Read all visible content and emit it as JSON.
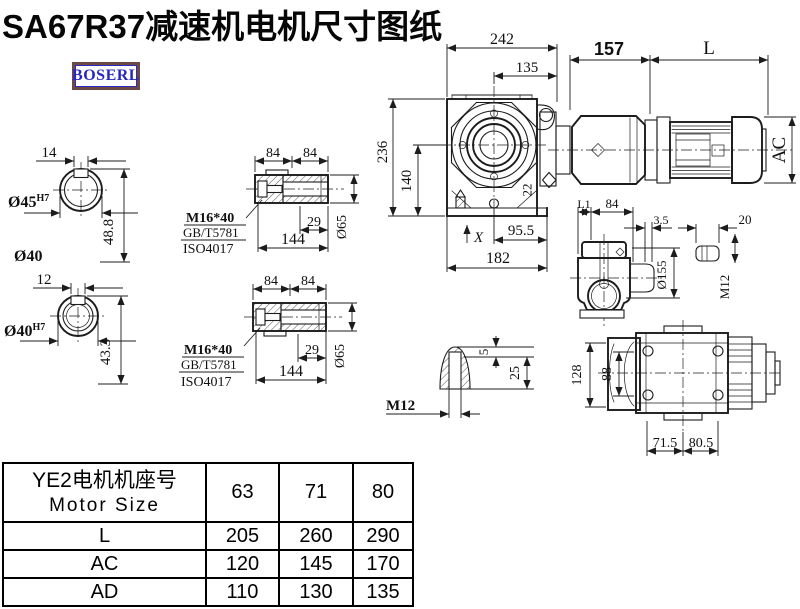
{
  "title": "SA67R37减速机电机尺寸图纸",
  "brand": {
    "text": "BOSERL"
  },
  "colors": {
    "line": "#1c1c1c",
    "brand_text": "#2626c0",
    "brand_border": "#6e4a45",
    "background": "#ffffff"
  },
  "drawing": {
    "shaft_top": {
      "keyway_width": "14",
      "bore": "Ø45",
      "bore_tol": "H7",
      "depth": "48.8",
      "outer_dia": "Ø40"
    },
    "shaft_bottom": {
      "keyway_width": "12",
      "bore": "Ø40",
      "bore_tol": "H7",
      "depth": "43.3"
    },
    "bushing_top": {
      "len1": "84",
      "len2": "84",
      "thread": "M16*40",
      "std1": "GB/T5781",
      "std2": "ISO4017",
      "key_len": "29",
      "total_len": "144",
      "dia": "Ø65"
    },
    "bushing_bottom": {
      "len1": "84",
      "len2": "84",
      "thread": "M16*40",
      "std1": "GB/T5781",
      "std2": "ISO4017",
      "key_len": "29",
      "total_len": "144",
      "dia": "Ø65"
    },
    "front_view": {
      "overall_w": "242",
      "center_to_face": "135",
      "adapter_len": "157",
      "motor_len": "L",
      "overall_h": "236",
      "center_h": "140",
      "foot": "22",
      "foot_to_center": "95.5",
      "base_len": "182",
      "datum": "X",
      "motor_dia": "AC"
    },
    "side_view": {
      "l1": "L1",
      "w84": "84",
      "gap": "3.5",
      "flange_dia": "Ø155",
      "stud_len": "20",
      "stud_thread": "M12"
    },
    "bottom_view": {
      "h128": "128",
      "h88": "88",
      "w1": "71.5",
      "w2": "80.5"
    },
    "plug_view": {
      "thread": "M12",
      "d5": "5",
      "d25": "25"
    }
  },
  "table": {
    "header": {
      "line1": "YE2电机机座号",
      "line2": "Motor Size"
    },
    "sizes": [
      "63",
      "71",
      "80"
    ],
    "rows": [
      {
        "label": "L",
        "values": [
          "205",
          "260",
          "290"
        ]
      },
      {
        "label": "AC",
        "values": [
          "120",
          "145",
          "170"
        ]
      },
      {
        "label": "AD",
        "values": [
          "110",
          "130",
          "135"
        ]
      }
    ]
  }
}
